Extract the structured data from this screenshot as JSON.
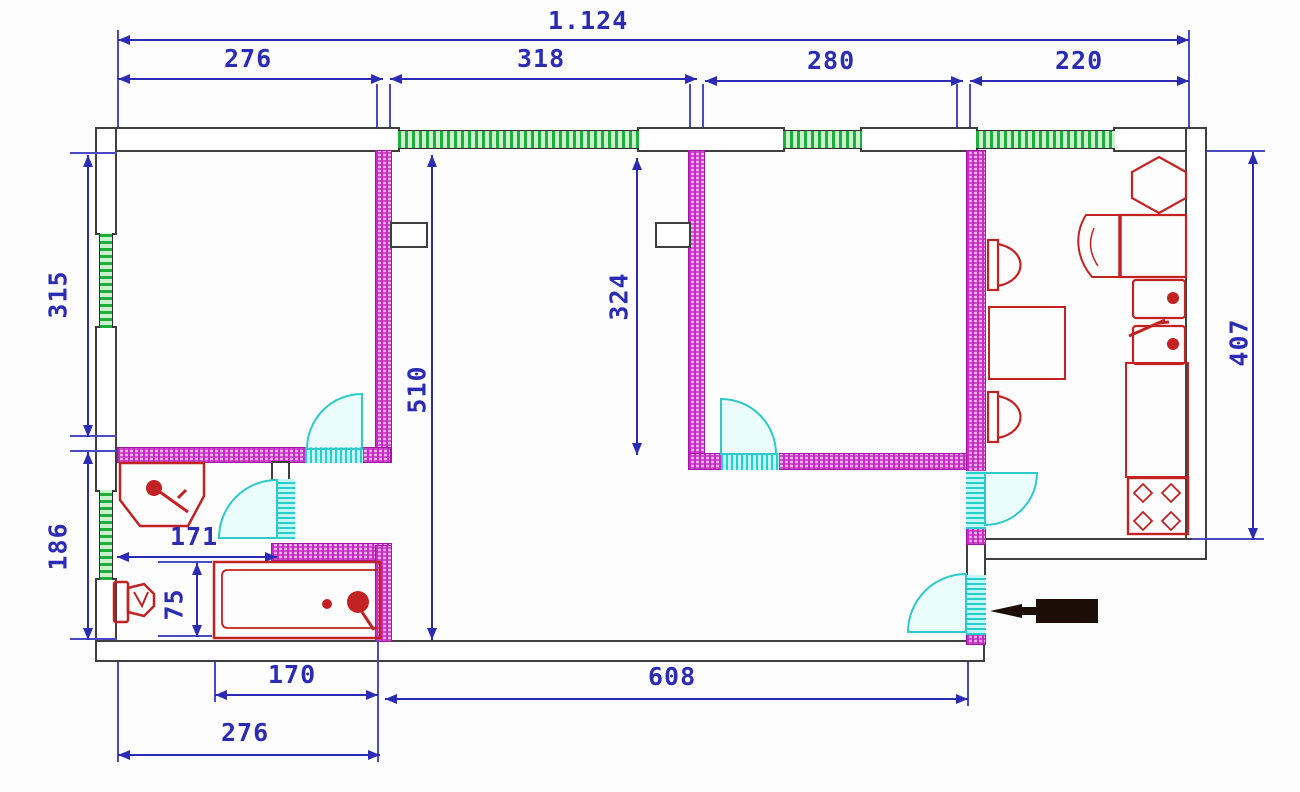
{
  "dims": {
    "overall": "1.124",
    "top": {
      "a": "276",
      "b": "318",
      "c": "280",
      "d": "220"
    },
    "left": {
      "a": "315",
      "b": "186"
    },
    "right": {
      "a": "407"
    },
    "inner": {
      "a": "510",
      "b": "324",
      "c": "171",
      "d": "75"
    },
    "bottom": {
      "a": "170",
      "b": "276",
      "c": "608"
    }
  },
  "colors": {
    "dimension": "#2b2bb4",
    "wall_outline": "#3f3f3f",
    "window_hatch": "#1fae3e",
    "partition_hatch": "#d024d0",
    "door_opening": "#25cfcf",
    "fixture": "#c22222",
    "entrance_arrow": "#1c0d06",
    "background": "#fdfdfd"
  },
  "icons": {
    "bathroom": [
      "sink-icon",
      "toilet-icon",
      "bathtub-icon"
    ],
    "kitchen": [
      "hexagon-fixture-icon",
      "corner-cabinet-icon",
      "double-sink-icon",
      "counter-icon",
      "stove-4-burner-icon",
      "chair-icon",
      "table-icon",
      "chair-icon"
    ],
    "entrance": [
      "entrance-direction-arrow-icon"
    ],
    "heating": [
      "vent-shaft-icon",
      "vent-shaft-icon"
    ]
  }
}
